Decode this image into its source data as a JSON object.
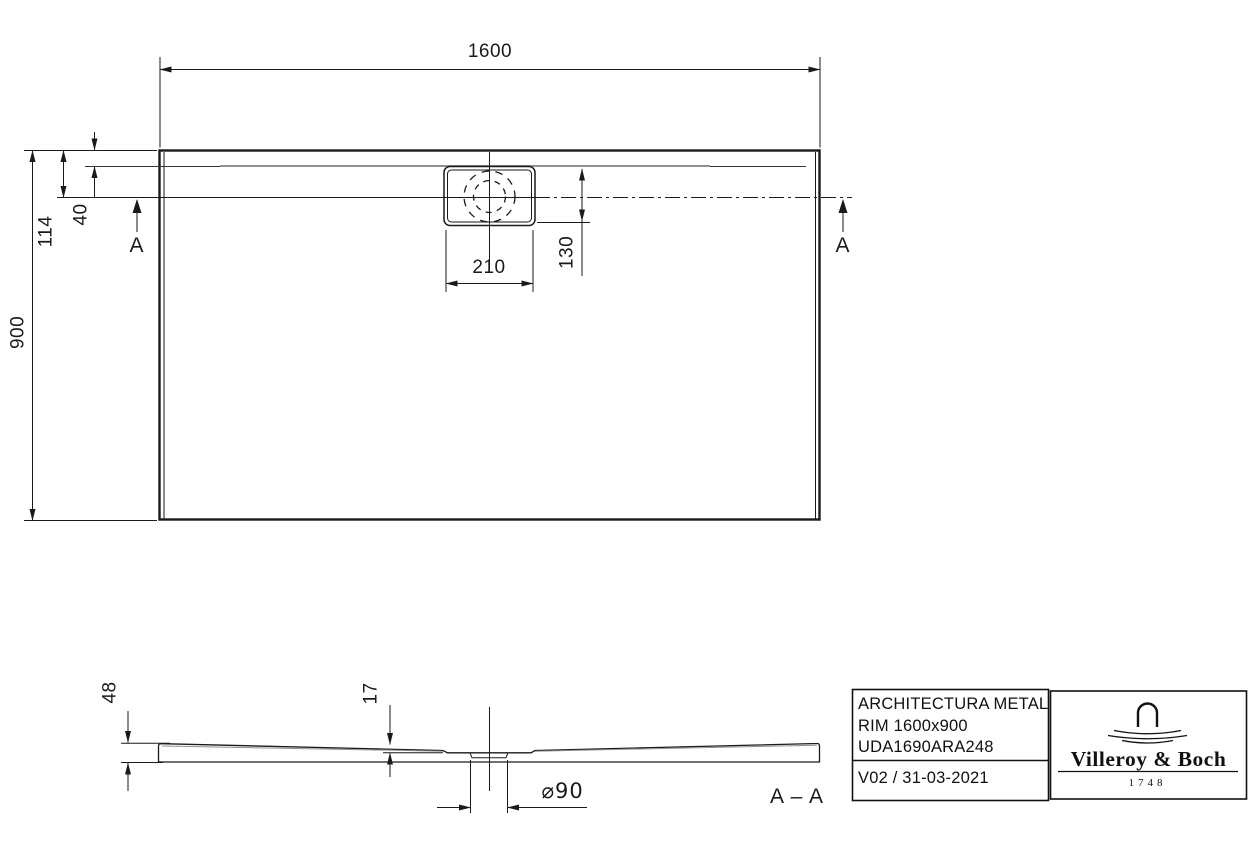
{
  "drawing": {
    "dims": {
      "width": "1600",
      "height": "900",
      "edge_to_center": "114",
      "rim": "40",
      "drain_box_width": "210",
      "drain_offset": "130",
      "tray_height": "48",
      "drain_depth": "17",
      "drain_diameter": "⌀90"
    },
    "markers": {
      "section_left": "A",
      "section_right": "A",
      "section_label": "A – A"
    }
  },
  "title_block": {
    "product_line1": "ARCHITECTURA METAL",
    "product_line2": "RIM 1600x900",
    "product_line3": "UDA1690ARA248",
    "version": "V02 / 31-03-2021",
    "brand": "Villeroy & Boch",
    "brand_year": "1748"
  },
  "colors": {
    "line": "#1a1a1a",
    "gray_line": "#909090",
    "background": "#ffffff"
  }
}
